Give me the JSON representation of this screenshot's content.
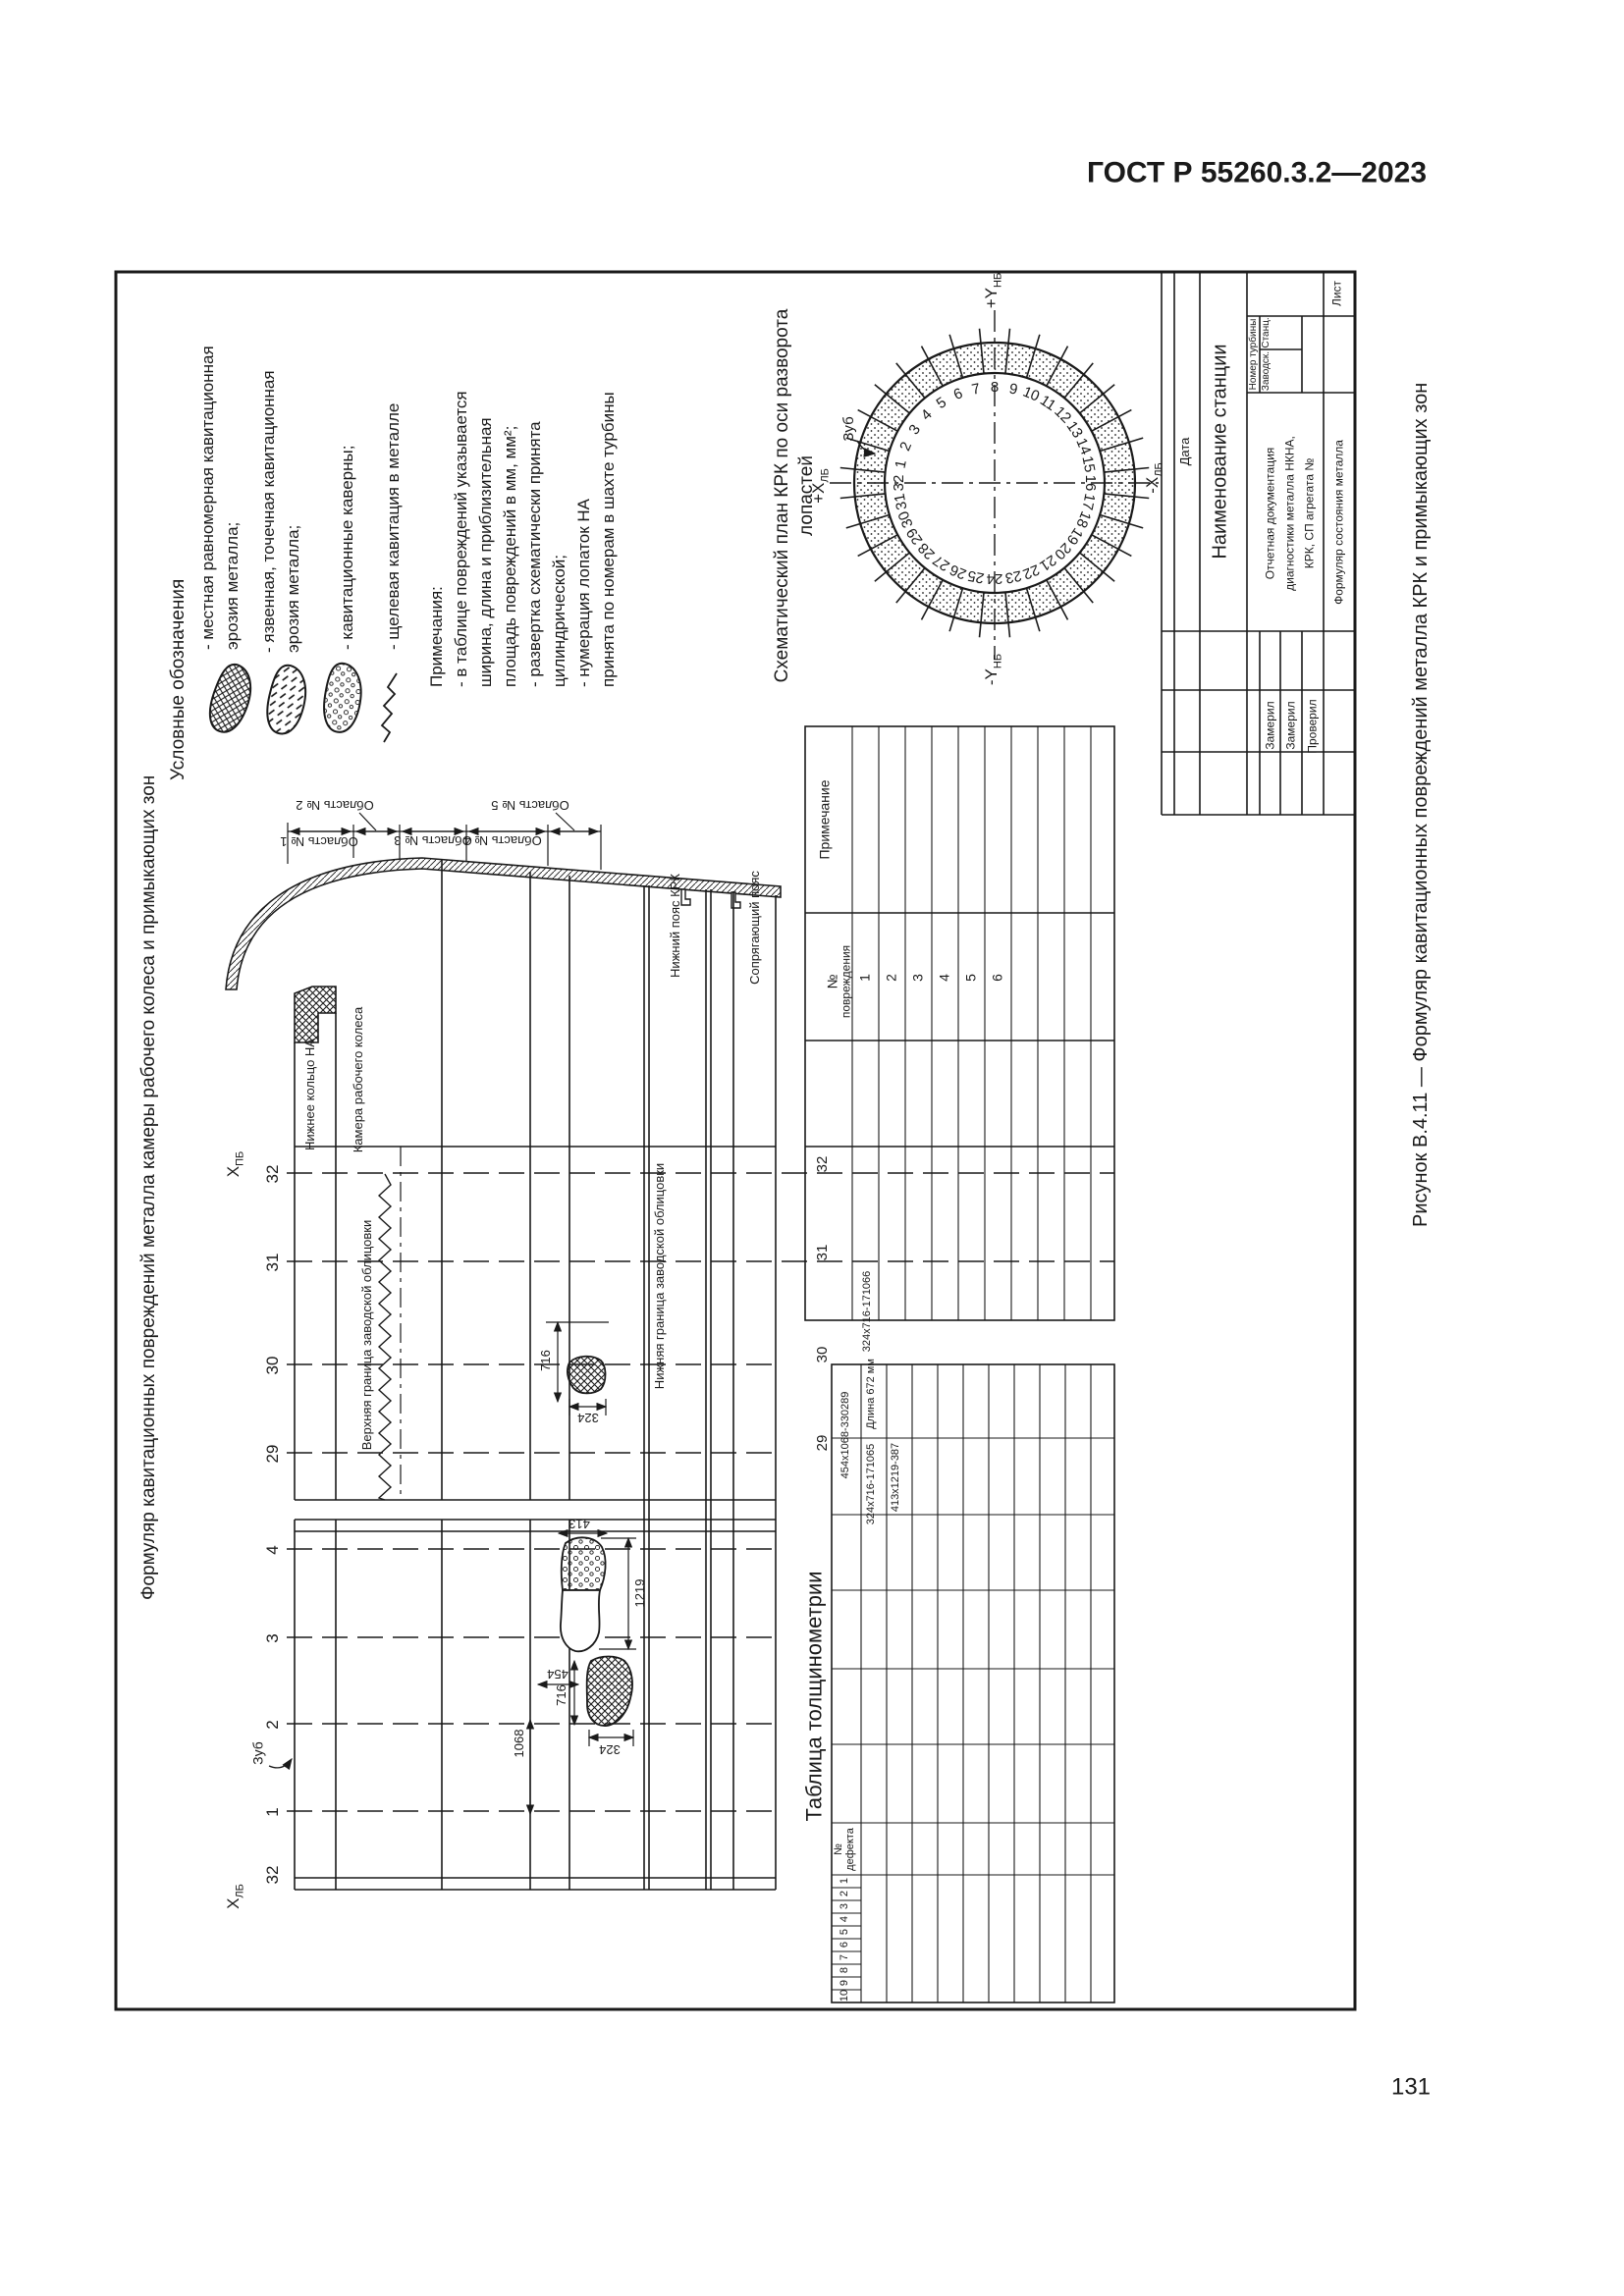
{
  "page": {
    "gost": "ГОСТ Р 55260.3.2—2023",
    "number": "131",
    "caption": "Рисунок В.4.11 — Формуляр кавитационных повреждений металла КРК и примыкающих зон",
    "vertical_title": "Формуляр кавитационных повреждений металла камеры рабочего колеса и примыкающих зон"
  },
  "legend": {
    "heading": "Условные обозначения",
    "item1_line1": "- местная равномерная кавитационная",
    "item1_line2": "эрозия металла;",
    "item2_line1": "- язвенная, точечная кавитационная",
    "item2_line2": "эрозия металла;",
    "item3": "- кавитационные каверны;",
    "item4": "- щелевая кавитация в металле",
    "symbols": [
      "crosshatch-blob",
      "dash-blob",
      "circles-blob",
      "zigzag-line"
    ]
  },
  "notes": {
    "l1": "Примечания:",
    "l2": "- в таблице повреждений указывается",
    "l3": "ширина, длина и приблизительная",
    "l4": "площадь повреждений в мм, мм²;",
    "l5": "- развертка схематически принята",
    "l6": "цилиндрической;",
    "l7": "- нумерация лопаток НА",
    "l8": "принята по номерам в шахте турбины"
  },
  "circle": {
    "title1": "Схематический план КРК по оси разворота",
    "title2": "лопастей",
    "tooth": "Зуб",
    "axis_top_main": "+Y",
    "axis_top_sub": "НБ",
    "axis_bottom_main": "-Y",
    "axis_bottom_sub": "НБ",
    "axis_left_main": "+Х",
    "axis_left_sub": "ЛБ",
    "axis_right_main": "-Х",
    "axis_right_sub": "ЛБ",
    "numbers": [
      "1",
      "2",
      "3",
      "4",
      "5",
      "6",
      "7",
      "8",
      "9",
      "10",
      "11",
      "12",
      "13",
      "14",
      "15",
      "16",
      "17",
      "18",
      "19",
      "20",
      "21",
      "22",
      "23",
      "24",
      "25",
      "26",
      "27",
      "28",
      "29",
      "30",
      "31",
      "32"
    ]
  },
  "development": {
    "axis_top_main": "Х",
    "axis_top_sub": "ПБ",
    "axis_bottom_main": "Х",
    "axis_bottom_sub": "ЛБ",
    "tooth": "Зуб",
    "upper_sections": [
      "32",
      "31",
      "30",
      "29"
    ],
    "lower_sections": [
      "4",
      "3",
      "2",
      "1",
      "32"
    ],
    "zone1": "Область № 1",
    "zone2": "Область № 2",
    "zone3": "Область № 3",
    "zone4": "Область № 4",
    "zone5": "Область № 5",
    "band_ring": "Нижнее кольцо НА",
    "band_chamber": "Камера рабочего колеса",
    "band_lower_belt": "Нижний пояс КРК",
    "band_mating_belt": "Сопрягающий пояс",
    "upper_liner_boundary": "Верхняя граница заводской облицовки",
    "lower_liner_boundary": "Нижняя граница заводской облицовки",
    "dim_716a": "716",
    "dim_324a": "324",
    "dim_413": "413",
    "dim_1219": "1219",
    "dim_716b": "716",
    "dim_324b": "324",
    "dim_454": "454",
    "dim_1068": "1068"
  },
  "damage_table": {
    "remark_header": "Примечание",
    "no_header_1": "№",
    "no_header_2": "повреждения",
    "rows": [
      "1",
      "2",
      "3",
      "4",
      "5",
      "6"
    ],
    "sections": [
      "32",
      "31",
      "30",
      "29"
    ],
    "entry1": "324х716-171066"
  },
  "thickness_table": {
    "title": "Таблица толщинометрии",
    "no_header_1": "№",
    "no_header_2": "дефекта",
    "rows": [
      "1",
      "2",
      "3",
      "4",
      "5",
      "6",
      "7",
      "8",
      "9",
      "10"
    ],
    "entry1": "454х1068-330289",
    "entry2": "Длина 672 мм",
    "entry3": "324х716-171065",
    "entry4": "413х1219-387"
  },
  "stamp": {
    "sheet": "Лист",
    "turbine_no": "Номер турбины",
    "station": "Станц.",
    "factory": "Заводск.",
    "station_name": "Наименование станции",
    "date": "Дата",
    "doc1": "Отчетная документация",
    "doc2": "диагностики металла НКНА,",
    "doc3": "КРК, СП агрегата №",
    "form": "Формуляр состояния металла",
    "measured1": "Замерил",
    "measured2": "Замерил",
    "checked": "Проверил"
  }
}
